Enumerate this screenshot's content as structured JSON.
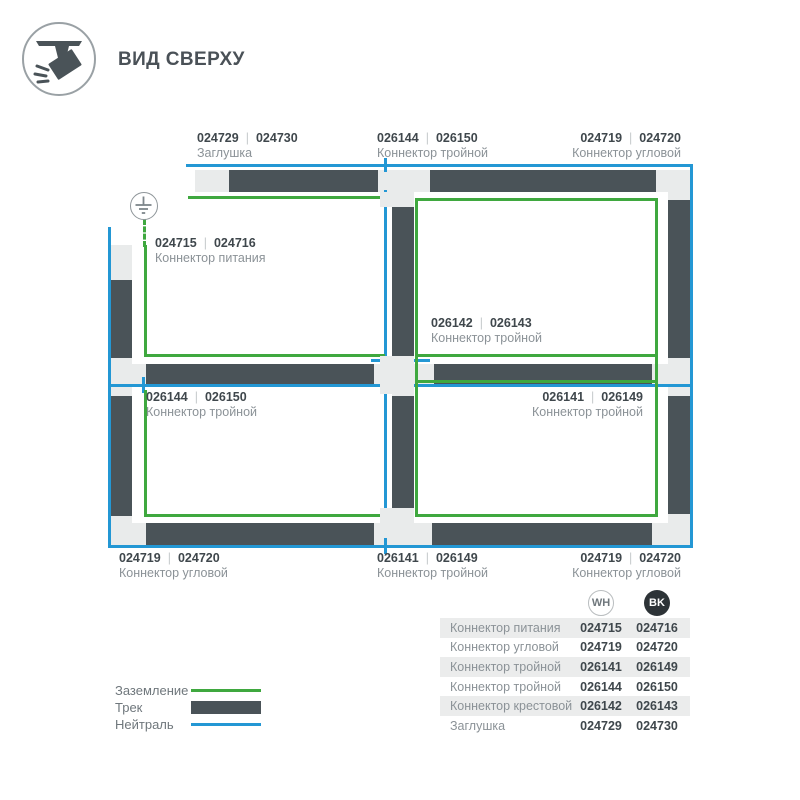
{
  "header": {
    "title": "ВИД СВЕРХУ"
  },
  "ui": {
    "num_separator": "|"
  },
  "colors": {
    "track": "#4a5358",
    "track_bg": "#e9ebeb",
    "neutral_blue": "#2397d4",
    "ground_green": "#3fa83f",
    "number_text": "#3f474c",
    "label_text": "#8b9297",
    "bk_badge": "#2d3337"
  },
  "diagram": {
    "labels": [
      {
        "num_wh": "024729",
        "num_bk": "024730",
        "name": "Заглушка"
      },
      {
        "num_wh": "026144",
        "num_bk": "026150",
        "name": "Коннектор тройной"
      },
      {
        "num_wh": "024719",
        "num_bk": "024720",
        "name": "Коннектор угловой"
      },
      {
        "num_wh": "024715",
        "num_bk": "024716",
        "name": "Коннектор питания"
      },
      {
        "num_wh": "026142",
        "num_bk": "026143",
        "name": "Коннектор тройной"
      },
      {
        "num_wh": "026144",
        "num_bk": "026150",
        "name": "Коннектор тройной"
      },
      {
        "num_wh": "026141",
        "num_bk": "026149",
        "name": "Коннектор тройной"
      },
      {
        "num_wh": "024719",
        "num_bk": "024720",
        "name": "Коннектор угловой"
      },
      {
        "num_wh": "026141",
        "num_bk": "026149",
        "name": "Коннектор тройной"
      },
      {
        "num_wh": "024719",
        "num_bk": "024720",
        "name": "Коннектор угловой"
      }
    ]
  },
  "legend": {
    "items": [
      {
        "label": "Заземление"
      },
      {
        "label": "Трек"
      },
      {
        "label": "Нейтраль"
      }
    ]
  },
  "table": {
    "col_wh": "WH",
    "col_bk": "BK",
    "rows": [
      {
        "name": "Коннектор питания",
        "wh": "024715",
        "bk": "024716"
      },
      {
        "name": "Коннектор угловой",
        "wh": "024719",
        "bk": "024720"
      },
      {
        "name": "Коннектор тройной",
        "wh": "026141",
        "bk": "026149"
      },
      {
        "name": "Коннектор тройной",
        "wh": "026144",
        "bk": "026150"
      },
      {
        "name": "Коннектор крестовой",
        "wh": "026142",
        "bk": "026143"
      },
      {
        "name": "Заглушка",
        "wh": "024729",
        "bk": "024730"
      }
    ]
  }
}
